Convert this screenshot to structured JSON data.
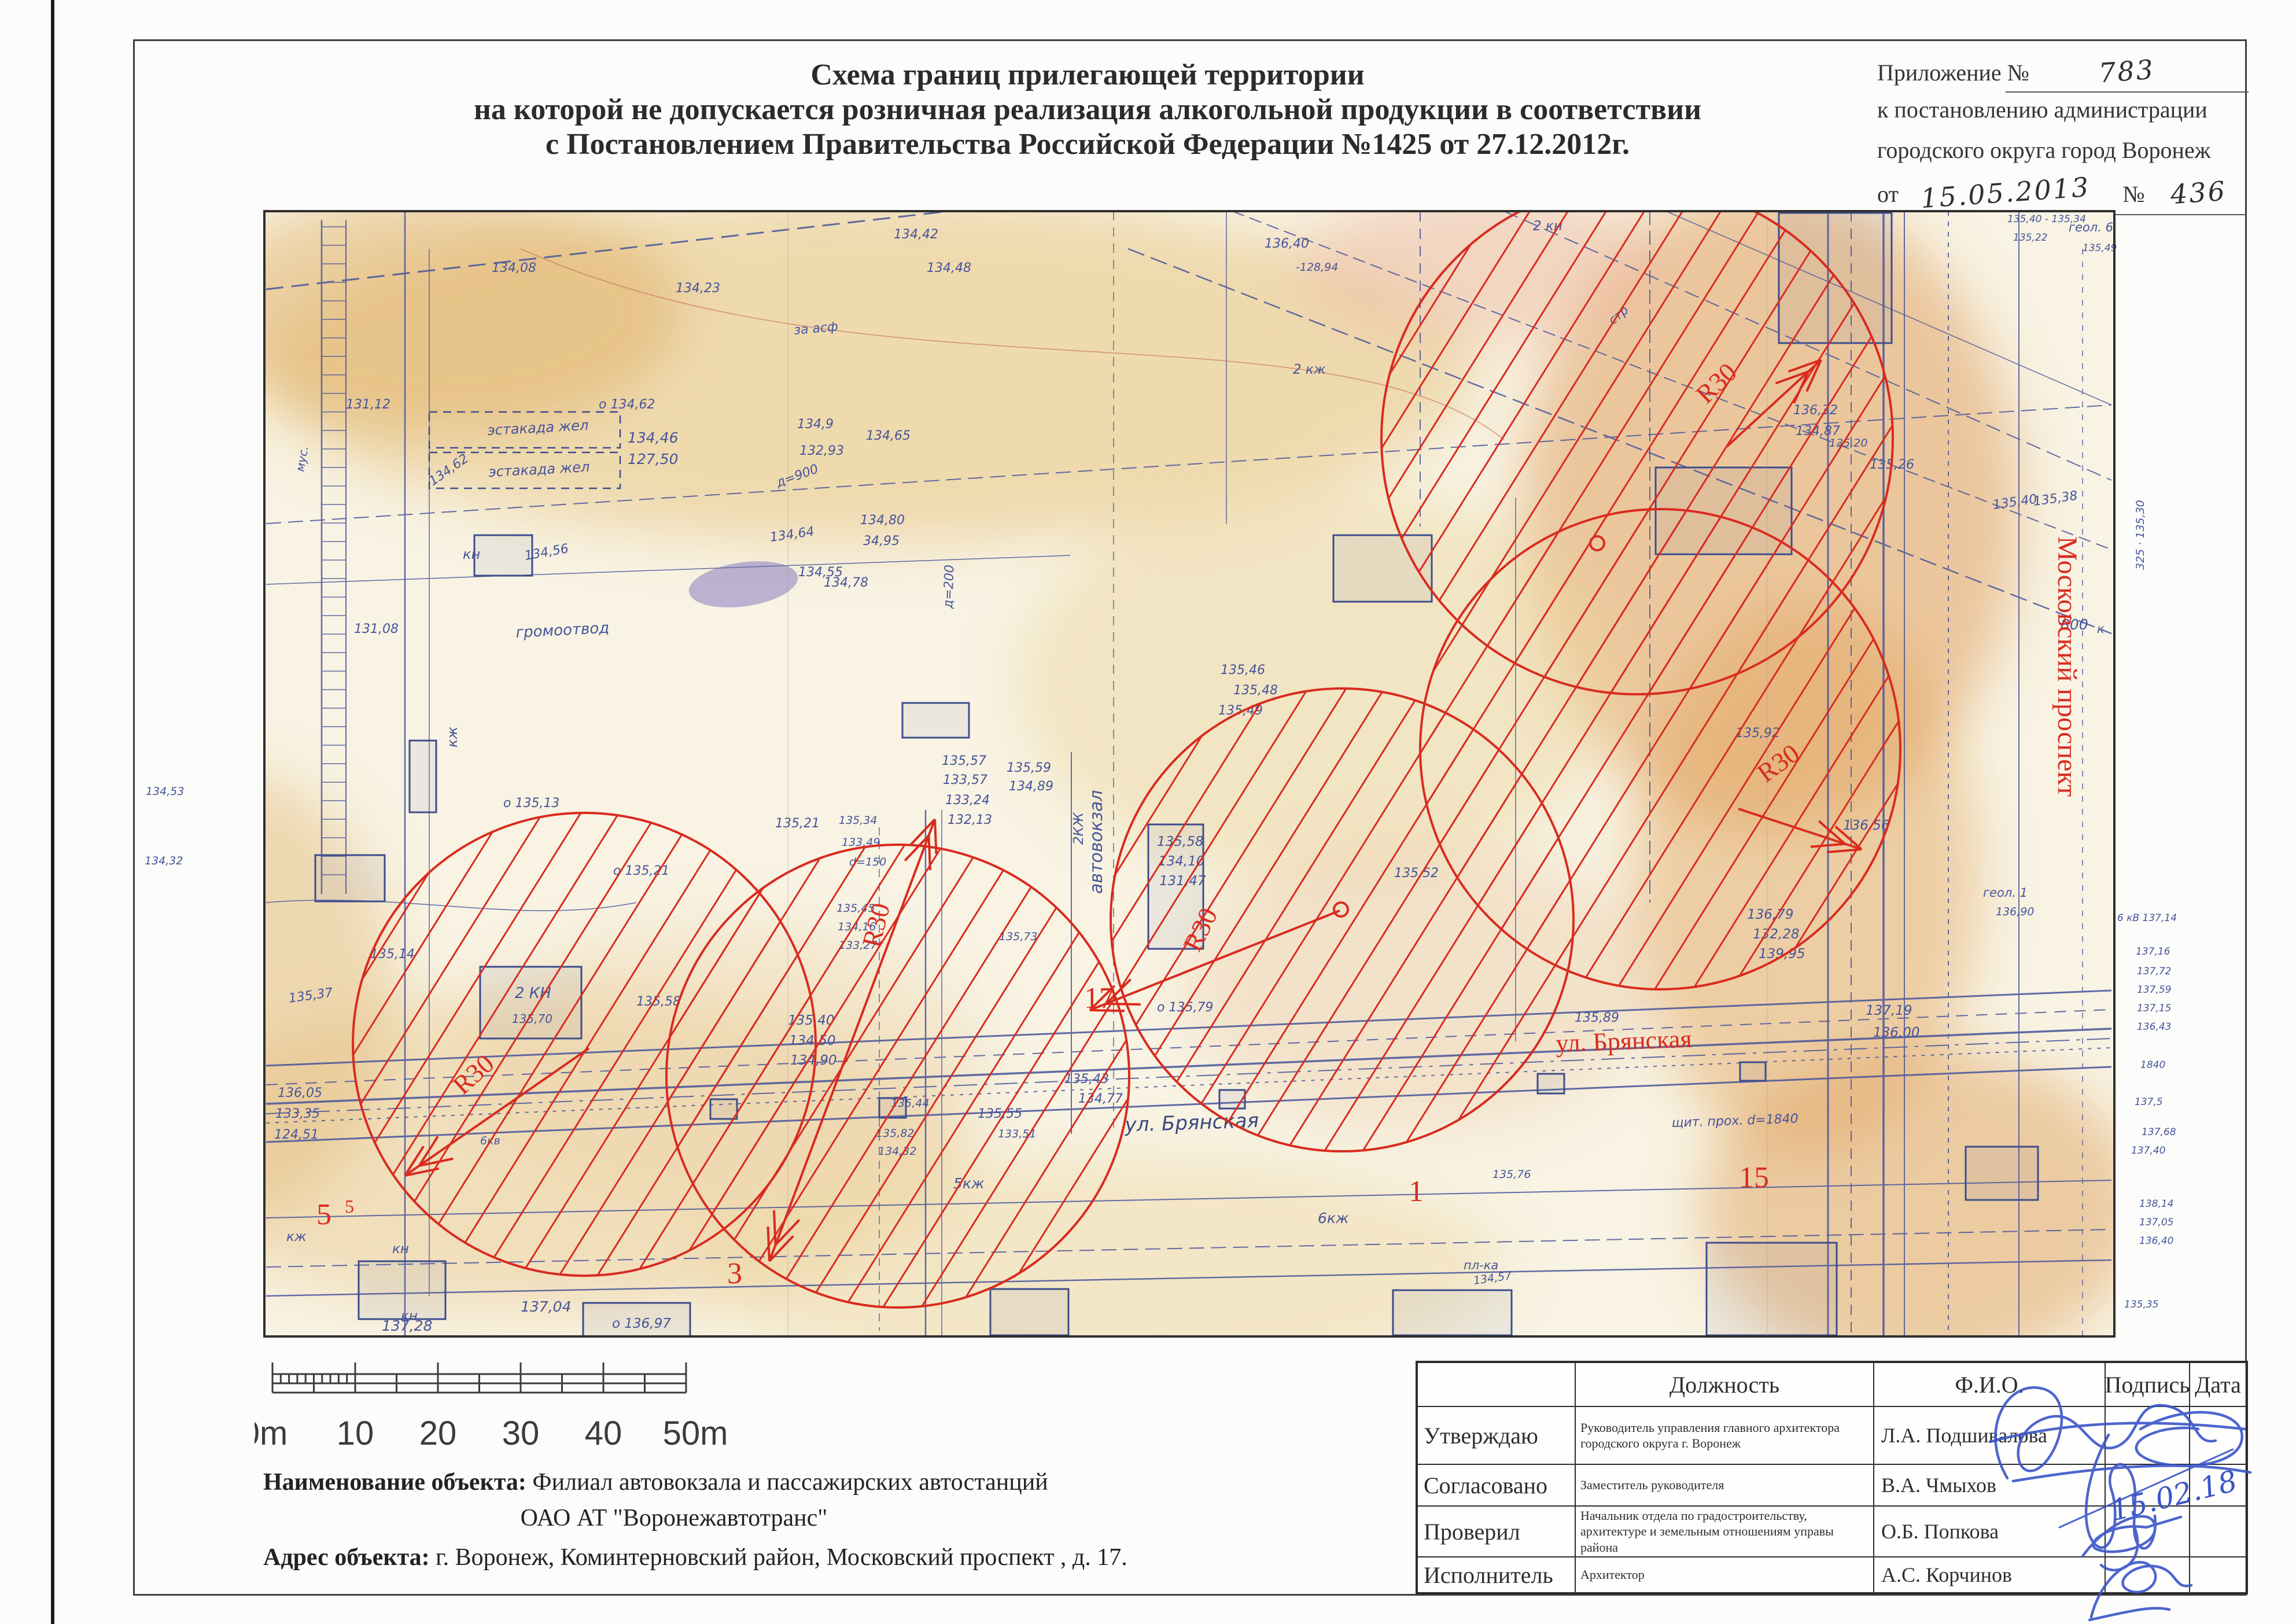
{
  "document": {
    "title_line1": "Схема границ прилегающей территории",
    "title_line2": "на которой не допускается розничная реализация алкогольной продукции в соответствии",
    "title_line3": "с Постановлением Правительства Российской Федерации №1425 от 27.12.2012г.",
    "annex": {
      "label": "Приложение №",
      "number": "783",
      "line2": "к постановлению администрации",
      "line3": "городского округа город Воронеж",
      "from_label": "от",
      "date": "15.05.2013",
      "no_label": "№",
      "no_value": "436"
    },
    "object": {
      "name_label": "Наименование объекта:",
      "name_value": "Филиал автовокзала и пассажирских автостанций",
      "name_value2": "ОАО АТ \"Воронежавтотранс\"",
      "address_label": "Адрес объекта:",
      "address_value": "г. Воронеж, Коминтерновский район, Московский проспект , д. 17."
    }
  },
  "scalebar": {
    "labels": [
      "0m",
      "10",
      "20",
      "30",
      "40",
      "50m"
    ]
  },
  "map": {
    "red_color": "#d92b1f",
    "blue_color": "#46549b",
    "dark_color": "#39497e",
    "radius_label": "R30",
    "circles": [
      [
        2830,
        758,
        442
      ],
      [
        2870,
        1295,
        415
      ],
      [
        2320,
        1590,
        400
      ],
      [
        1010,
        1805,
        400
      ],
      [
        1552,
        1860,
        400
      ]
    ],
    "radius_arrows": [
      [
        2985,
        772,
        3148,
        622,
        2950,
        700,
        -44,
        0
      ],
      [
        3005,
        1398,
        3218,
        1468,
        3052,
        1354,
        -36,
        0
      ],
      [
        2316,
        1574,
        1884,
        1746,
        2072,
        1648,
        -64,
        0
      ],
      [
        1018,
        1812,
        700,
        2032,
        800,
        1894,
        -42,
        0
      ],
      [
        1330,
        2180,
        1616,
        1416,
        1520,
        1640,
        -76,
        1
      ]
    ],
    "center_dots": [
      [
        2761,
        939
      ],
      [
        2318,
        1572
      ]
    ],
    "red_labels": [
      [
        560,
        2116,
        "5",
        52,
        0
      ],
      [
        604,
        2096,
        "5",
        32,
        0
      ],
      [
        1270,
        2218,
        "3",
        52,
        0
      ],
      [
        1900,
        1742,
        "17",
        52,
        0
      ],
      [
        2448,
        2076,
        "1",
        52,
        0
      ],
      [
        3032,
        2052,
        "15",
        52,
        0
      ],
      [
        2690,
        1818,
        "ул. Брянская",
        44,
        -2
      ],
      [
        3558,
        1152,
        "Московский проспект",
        48,
        90
      ]
    ],
    "blue_labels": [
      [
        850,
        470,
        "134,08"
      ],
      [
        1168,
        505,
        "134,23"
      ],
      [
        1545,
        412,
        "134,42"
      ],
      [
        1602,
        470,
        "134,48"
      ],
      [
        2186,
        428,
        "136,40"
      ],
      [
        2240,
        468,
        "-128,94",
        0,
        19
      ],
      [
        1035,
        706,
        "о 134,62"
      ],
      [
        598,
        706,
        "131,12"
      ],
      [
        748,
        840,
        "134,62",
        -35
      ],
      [
        800,
        966,
        "кн",
        0,
        24
      ],
      [
        908,
        968,
        "134,56",
        -10
      ],
      [
        612,
        1094,
        "131,08"
      ],
      [
        892,
        1102,
        "громоотвод",
        -3,
        26
      ],
      [
        1380,
        996,
        "134,55"
      ],
      [
        1373,
        578,
        "за асф",
        -5
      ],
      [
        1085,
        765,
        "134,46",
        0,
        25
      ],
      [
        1085,
        802,
        "127,50",
        0,
        25
      ],
      [
        1378,
        740,
        "134,9"
      ],
      [
        1382,
        786,
        "132,93"
      ],
      [
        1497,
        760,
        "134,65"
      ],
      [
        1345,
        842,
        "д=900",
        -20
      ],
      [
        1332,
        936,
        "134,64",
        -8
      ],
      [
        1487,
        906,
        "134,80"
      ],
      [
        1492,
        942,
        "34,95"
      ],
      [
        1424,
        1014,
        "134,78"
      ],
      [
        525,
        816,
        "мус.",
        -80,
        20
      ],
      [
        790,
        1292,
        "кж",
        -90,
        24
      ],
      [
        252,
        1374,
        "134,53",
        0,
        19
      ],
      [
        250,
        1494,
        "134,32",
        0,
        19
      ],
      [
        2235,
        646,
        "2 кж",
        0,
        23
      ],
      [
        2650,
        398,
        "2 кн",
        0,
        23
      ],
      [
        2788,
        562,
        "стр",
        -40,
        21
      ],
      [
        3100,
        716,
        "136,32"
      ],
      [
        3104,
        752,
        "134,87"
      ],
      [
        3162,
        772,
        "135,20",
        0,
        19
      ],
      [
        3232,
        810,
        "135,26"
      ],
      [
        3245,
        224,
        "СМ",
        0,
        23
      ],
      [
        3252,
        256,
        "6эт",
        0,
        19
      ],
      [
        3400,
        202,
        "о 135,82"
      ],
      [
        3448,
        244,
        "134,86"
      ],
      [
        3452,
        280,
        "-29,73"
      ],
      [
        3452,
        350,
        "геол. 7",
        0,
        21
      ],
      [
        3470,
        384,
        "135,40 - 135,34",
        0,
        17
      ],
      [
        3480,
        416,
        "135,22",
        0,
        17
      ],
      [
        3576,
        400,
        "геол. 6",
        0,
        21
      ],
      [
        3600,
        434,
        "135,49",
        0,
        17
      ],
      [
        1628,
        1322,
        "135,57"
      ],
      [
        1630,
        1355,
        "133,57"
      ],
      [
        1634,
        1390,
        "133,24"
      ],
      [
        1638,
        1424,
        "132,13"
      ],
      [
        1740,
        1334,
        "135,59"
      ],
      [
        1744,
        1366,
        "134,89"
      ],
      [
        1905,
        1545,
        "автовокзал",
        -90,
        30
      ],
      [
        1872,
        1460,
        "2КЖ",
        -90,
        23
      ],
      [
        1646,
        1052,
        "д=200",
        -88
      ],
      [
        870,
        1395,
        "о 135,13"
      ],
      [
        640,
        1656,
        "135,14"
      ],
      [
        500,
        1733,
        "135,37",
        -8
      ],
      [
        1060,
        1512,
        "о 135,21"
      ],
      [
        1340,
        1430,
        "135,21"
      ],
      [
        1450,
        1424,
        "135,34",
        0,
        19
      ],
      [
        1455,
        1462,
        "133,49",
        0,
        19
      ],
      [
        1468,
        1496,
        "d=150",
        0,
        19
      ],
      [
        1446,
        1576,
        "135,45",
        0,
        19
      ],
      [
        1448,
        1608,
        "134,16",
        0,
        19
      ],
      [
        1450,
        1640,
        "133,27",
        0,
        19
      ],
      [
        1727,
        1625,
        "135,73",
        0,
        19
      ],
      [
        1100,
        1738,
        "135,58"
      ],
      [
        890,
        1725,
        "2 КН",
        0,
        26
      ],
      [
        885,
        1768,
        "135,70",
        0,
        20
      ],
      [
        1362,
        1771,
        "135,40",
        0,
        23
      ],
      [
        1364,
        1806,
        "134,50",
        0,
        23
      ],
      [
        1366,
        1840,
        "134,90",
        0,
        23
      ],
      [
        1540,
        1913,
        "135,44",
        0,
        19
      ],
      [
        1514,
        1965,
        "135,82",
        0,
        19
      ],
      [
        1518,
        1996,
        "134,32",
        0,
        19
      ],
      [
        2000,
        1462,
        "135,58",
        0,
        23
      ],
      [
        2002,
        1496,
        "134,10",
        0,
        23
      ],
      [
        2004,
        1530,
        "131,47",
        0,
        23
      ],
      [
        2110,
        1165,
        "135,46"
      ],
      [
        2132,
        1200,
        "135,48"
      ],
      [
        2106,
        1235,
        "135,49"
      ],
      [
        2410,
        1516,
        "135,52"
      ],
      [
        2000,
        1748,
        "о 135,79"
      ],
      [
        3000,
        1274,
        "135,92"
      ],
      [
        3186,
        1434,
        "136,56",
        0,
        23
      ],
      [
        2722,
        1766,
        "135,89"
      ],
      [
        3225,
        1754,
        "137,19",
        0,
        23
      ],
      [
        3238,
        1792,
        "136,00",
        0,
        23
      ],
      [
        3446,
        880,
        "135,40",
        -8
      ],
      [
        3516,
        874,
        "135,38",
        -8
      ],
      [
        3562,
        1088,
        "800",
        0,
        25
      ],
      [
        3625,
        1094,
        "к",
        0,
        21
      ],
      [
        3706,
        985,
        "325 · 135,30",
        -90,
        19
      ],
      [
        3428,
        1550,
        "геол. 1",
        0,
        21
      ],
      [
        3450,
        1582,
        "136,90",
        0,
        19
      ],
      [
        1840,
        1872,
        "135,43"
      ],
      [
        1864,
        1906,
        "134,77"
      ],
      [
        1690,
        1932,
        "135,55"
      ],
      [
        1725,
        1966,
        "133,51",
        0,
        19
      ],
      [
        1945,
        1956,
        "ул. Брянская",
        -2,
        34,
        "dark"
      ],
      [
        2890,
        1948,
        "щит. прох. d=1840",
        -2
      ],
      [
        830,
        1978,
        "6кв",
        0,
        19
      ],
      [
        1648,
        2054,
        "5кж",
        0,
        25
      ],
      [
        2278,
        2114,
        "6кж",
        0,
        25
      ],
      [
        2580,
        2036,
        "135,76",
        0,
        19
      ],
      [
        2530,
        2194,
        "пл-ка",
        0,
        21
      ],
      [
        2548,
        2220,
        "134,57",
        -8,
        19
      ],
      [
        900,
        2267,
        "137,04",
        0,
        25
      ],
      [
        1058,
        2295,
        "о 136,97",
        0,
        23
      ],
      [
        660,
        2300,
        "137,28",
        0,
        25
      ],
      [
        480,
        1896,
        "136,05"
      ],
      [
        476,
        1932,
        "133,35"
      ],
      [
        474,
        1968,
        "124,51"
      ],
      [
        495,
        2145,
        "кж",
        0,
        23
      ],
      [
        678,
        2166,
        "кн",
        0,
        23
      ],
      [
        693,
        2282,
        "кн",
        0,
        23
      ],
      [
        3020,
        1588,
        "136,79",
        0,
        23
      ],
      [
        3030,
        1622,
        "132,28",
        0,
        23
      ],
      [
        3040,
        1656,
        "139,95",
        0,
        23
      ],
      [
        3660,
        1592,
        "6 кВ 137,14",
        0,
        17
      ],
      [
        3692,
        1650,
        "137,16",
        0,
        17
      ],
      [
        3694,
        1684,
        "137,72",
        0,
        17
      ],
      [
        3694,
        1716,
        "137,59",
        0,
        17
      ],
      [
        3694,
        1748,
        "137,15",
        0,
        17
      ],
      [
        3694,
        1780,
        "136,43",
        0,
        17
      ],
      [
        3700,
        1846,
        "1840",
        0,
        17
      ],
      [
        3690,
        1910,
        "137,5",
        0,
        17
      ],
      [
        3702,
        1962,
        "137,68",
        0,
        17
      ],
      [
        3684,
        1994,
        "137,40",
        0,
        17
      ],
      [
        3698,
        2086,
        "138,14",
        0,
        17
      ],
      [
        3698,
        2118,
        "137,05",
        0,
        17
      ],
      [
        3698,
        2150,
        "136,40",
        0,
        17
      ],
      [
        3672,
        2260,
        "135,35",
        0,
        17
      ],
      [
        843,
        752,
        "эстакада жел",
        -3,
        24
      ],
      [
        845,
        824,
        "эстакада жел",
        -3,
        24
      ]
    ]
  },
  "table": {
    "headers": [
      "",
      "Должность",
      "Ф.И.О.",
      "Подпись",
      "Дата"
    ],
    "rows": [
      {
        "role": "Утверждаю",
        "position": "Руководитель управления главного архитектора городского округа г. Воронеж",
        "name": "Л.А. Подшивалова"
      },
      {
        "role": "Согласовано",
        "position": "Заместитель руководителя",
        "name": "В.А. Чмыхов"
      },
      {
        "role": "Проверил",
        "position": "Начальник отдела по градостроительству, архитектуре и земельным отношениям управы района",
        "name": "О.Б. Попкова"
      },
      {
        "role": "Исполнитель",
        "position": "Архитектор",
        "name": "А.С. Корчинов"
      }
    ],
    "handwritten_date": "15.02.18"
  }
}
